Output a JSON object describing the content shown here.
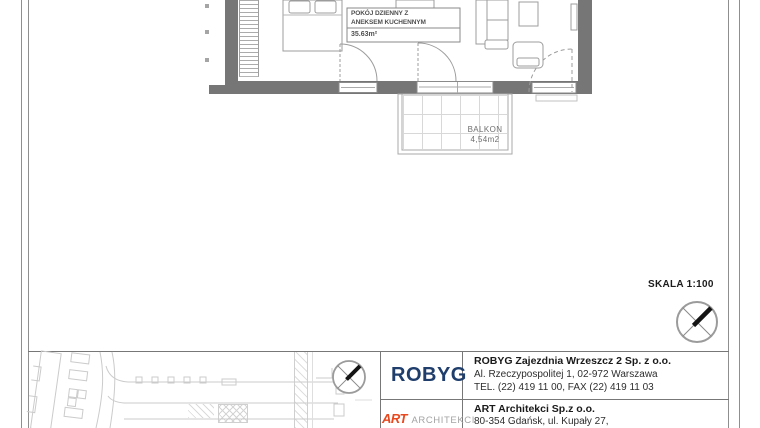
{
  "plan": {
    "room": {
      "name_line1": "POKÓJ DZIENNY Z",
      "name_line2": "ANEKSEM KUCHENNYM",
      "area": "35.63m²"
    },
    "balcony": {
      "name": "BALKON",
      "area": "4,54m2"
    }
  },
  "scale_label": "SKALA 1:100",
  "title_block": {
    "developer": {
      "logo_text": "ROBYG",
      "company": "ROBYG Zajezdnia Wrzeszcz 2 Sp. z o.o.",
      "address": "Al. Rzeczypospolitej 1, 02-972 Warszawa",
      "contact": "TEL. (22) 419 11 00, FAX (22) 419 11 03"
    },
    "architect": {
      "logo_text": "ART",
      "logo_subtext": "ARCHITEKCI",
      "company": "ART Architekci Sp.z o.o.",
      "address": "80-354 Gdańsk, ul. Kupały 27,"
    }
  },
  "icons": {
    "north_compass": "north-arrow-compass"
  },
  "colors": {
    "wall_gray": "#767676",
    "line_gray": "#9c9c9c",
    "robyg_blue": "#1f3e6c",
    "art_red": "#e8491f"
  }
}
